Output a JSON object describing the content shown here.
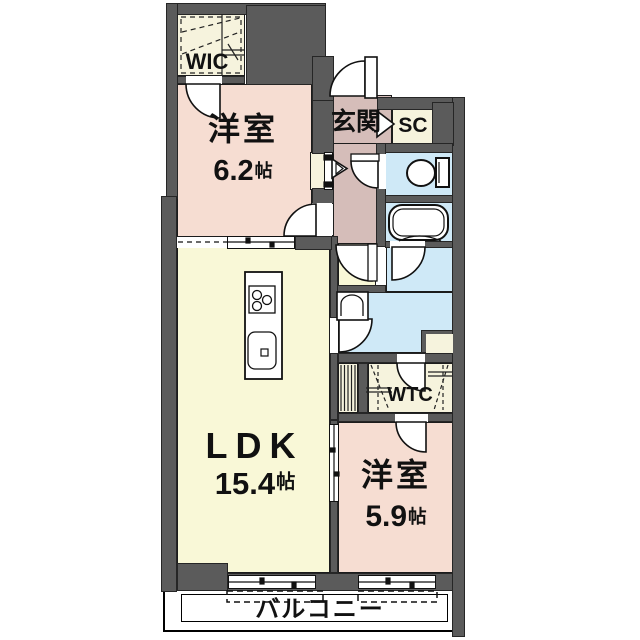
{
  "plan_title": "apartment-floor-plan",
  "rooms": {
    "wic": {
      "label": "WIC"
    },
    "bedroom_top": {
      "name": "洋室",
      "size_value": "6.2",
      "size_unit": "帖"
    },
    "entrance": {
      "label": "玄関"
    },
    "shoe_closet": {
      "label": "SC"
    },
    "walk_through_closet": {
      "label": "WTC"
    },
    "ldk": {
      "name": "LDK",
      "size_value": "15.4",
      "size_unit": "帖"
    },
    "bedroom_bottom": {
      "name": "洋室",
      "size_value": "5.9",
      "size_unit": "帖"
    },
    "balcony": {
      "label": "バルコニー"
    }
  },
  "fixtures": {
    "toilet": "toilet-icon",
    "bathtub": "bathtub-icon",
    "wash_basin": "wash-basin-icon",
    "kitchen_counter": "kitchen-counter-icon"
  },
  "colors": {
    "wall": "#5b5b5b",
    "bedroom": "#f6ddd2",
    "ldk": "#f9f8d7",
    "wet_area": "#cfe9f7",
    "entrance_hall": "#d5bdb9",
    "closet": "#f6f3dd",
    "outline": "#1c1c1c"
  }
}
